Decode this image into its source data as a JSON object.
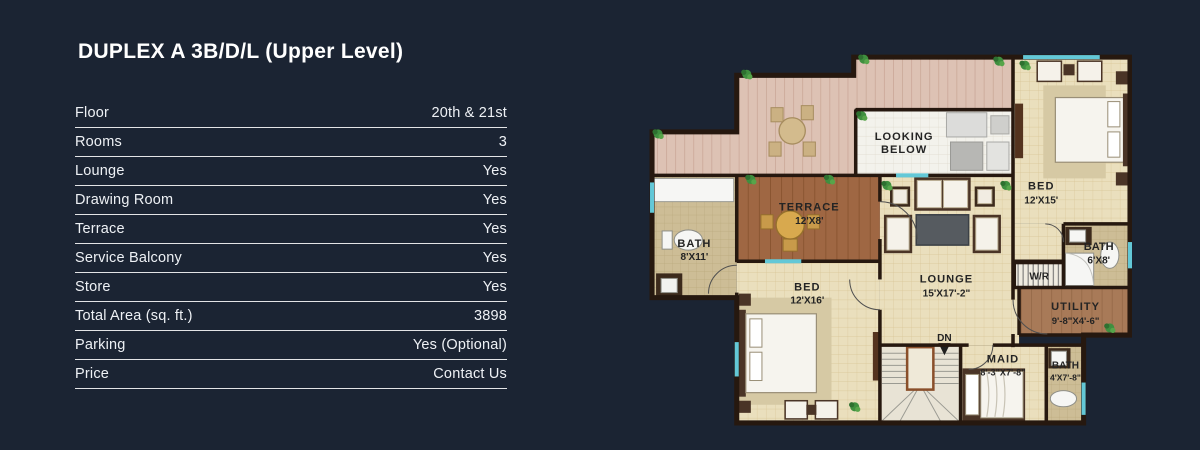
{
  "page": {
    "title": "DUPLEX A 3B/D/L (Upper Level)"
  },
  "spec_table": {
    "rows": [
      {
        "label": "Floor",
        "value": "20th & 21st"
      },
      {
        "label": "Rooms",
        "value": "3"
      },
      {
        "label": "Lounge",
        "value": "Yes"
      },
      {
        "label": "Drawing Room",
        "value": "Yes"
      },
      {
        "label": "Terrace",
        "value": "Yes"
      },
      {
        "label": "Service Balcony",
        "value": "Yes"
      },
      {
        "label": "Store",
        "value": "Yes"
      },
      {
        "label": "Total Area (sq. ft.)",
        "value": "3898"
      },
      {
        "label": "Parking",
        "value": "Yes (Optional)"
      },
      {
        "label": "Price",
        "value": "Contact Us"
      }
    ]
  },
  "floor_plan": {
    "labels": {
      "looking_below_1": "LOOKING",
      "looking_below_2": "BELOW",
      "terrace_name": "TERRACE",
      "terrace_dims": "12'X8'",
      "bath_main_name": "BATH",
      "bath_main_dims": "8'X11'",
      "bed1_name": "BED",
      "bed1_dims": "12'X16'",
      "lounge_name": "LOUNGE",
      "lounge_dims": "15'X17'-2\"",
      "bed2_name": "BED",
      "bed2_dims": "12'X15'",
      "bath2_name": "BATH",
      "bath2_dims": "6'X8'",
      "wr_name": "W/R",
      "utility_name": "UTILITY",
      "utility_dims": "9'-8\"X4'-6\"",
      "stairs_dn": "DN",
      "maid_name": "MAID",
      "maid_dims": "8'-3\"X7'-8\"",
      "bath3_name": "BATH",
      "bath3_dims": "4'X7'-8\""
    },
    "colors": {
      "background": "#1b2433",
      "wall": "#26180f",
      "tile_floor": "#eadfbd",
      "deck_wood": "#ddc2b4",
      "terrace_wood": "#9f6743",
      "utility_wood": "#a87a58",
      "bath_tile": "#cdbd96",
      "window_accent": "#63c8d7",
      "plant_green": "#3f8f3f"
    }
  }
}
